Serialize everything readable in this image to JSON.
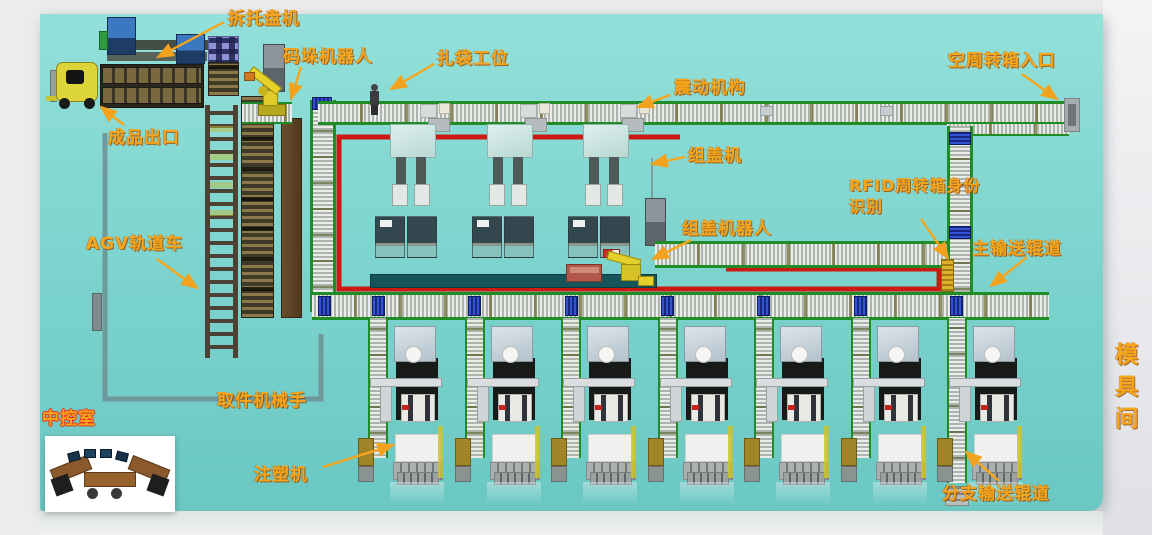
{
  "scene_labels": [
    {
      "id": "pallet-unstacker",
      "text": "拆托盘机",
      "x": 228,
      "y": 8,
      "arrow": [
        224,
        22,
        158,
        57
      ]
    },
    {
      "id": "palletizing-robot",
      "text": "码垛机器人",
      "x": 283,
      "y": 46,
      "arrow": [
        301,
        67,
        291,
        99
      ]
    },
    {
      "id": "bagging-station",
      "text": "扎袋工位",
      "x": 437,
      "y": 48,
      "arrow": [
        434,
        64,
        391,
        89
      ]
    },
    {
      "id": "vibration-mechanism",
      "text": "震动机构",
      "x": 674,
      "y": 77,
      "arrow": [
        670,
        95,
        638,
        107
      ]
    },
    {
      "id": "empty-turnover-box-entrance",
      "text": "空周转箱入口",
      "x": 948,
      "y": 50,
      "arrow": [
        1022,
        74,
        1057,
        99
      ]
    },
    {
      "id": "finished-product-exit",
      "text": "成品出口",
      "x": 108,
      "y": 127,
      "arrow": [
        124,
        125,
        101,
        107
      ]
    },
    {
      "id": "cap-assembly-machine",
      "text": "组盖机",
      "x": 688,
      "y": 145,
      "arrow": [
        685,
        157,
        652,
        164
      ]
    },
    {
      "id": "rfid-turnover-box-identification",
      "text": "RFID周转箱身份识别",
      "x": 849,
      "y": 176,
      "wrap": true,
      "arrow": [
        921,
        219,
        948,
        258
      ]
    },
    {
      "id": "cap-assembly-robot",
      "text": "组盖机器人",
      "x": 682,
      "y": 218,
      "arrow": [
        691,
        240,
        653,
        259
      ]
    },
    {
      "id": "main-conveyor-roller",
      "text": "主输送辊道",
      "x": 972,
      "y": 238,
      "arrow": [
        1027,
        257,
        991,
        286
      ]
    },
    {
      "id": "agv-rail-car",
      "text": "AGV轨道车",
      "x": 86,
      "y": 233,
      "arrow": [
        157,
        259,
        197,
        288
      ]
    },
    {
      "id": "picking-manipulator",
      "text": "取件机械手",
      "x": 217,
      "y": 390
    },
    {
      "id": "central-control-room",
      "text": "中控室",
      "x": 42,
      "y": 408,
      "redout": true
    },
    {
      "id": "injection-molding-machine",
      "text": "注塑机",
      "x": 254,
      "y": 464,
      "arrow": [
        323,
        467,
        393,
        445
      ]
    },
    {
      "id": "branch-conveyor-roller",
      "text": "分支输送辊道",
      "x": 942,
      "y": 483,
      "arrow": [
        999,
        481,
        966,
        452
      ]
    },
    {
      "id": "mold-room",
      "text": "模具间",
      "x": 1108,
      "y": 342,
      "vertical": true
    }
  ],
  "colors": {
    "label_orange": "#f7a61b",
    "fence_red": "#ce1812",
    "conveyor_green": "#1f8c25",
    "floor_teal": "#7fd5cf",
    "tote_blue": "#2b46c8",
    "robot_yellow": "#e3cf2a",
    "agv_path_gray": "#6d9396"
  },
  "machines": {
    "count": 7,
    "conveyor_x0": 368,
    "pitch": 96.5
  },
  "cap_stations": {
    "count": 3,
    "x0": 390,
    "pitch": 96.5
  },
  "bottom_totes_x": [
    318,
    372,
    468,
    565,
    661,
    757,
    854,
    950
  ],
  "vertical_totes_y": [
    132,
    226
  ],
  "vibration_units_x": [
    420,
    520,
    620
  ],
  "conveyor_items_x": [
    760,
    880
  ],
  "fence_path": "M680,137 L339,137 L339,289 L939,289 L939,269 L726,269",
  "agv_path": "M105,133 L105,399 L321,399 L321,334",
  "cabinet_wire": "M652,158 L652,198"
}
